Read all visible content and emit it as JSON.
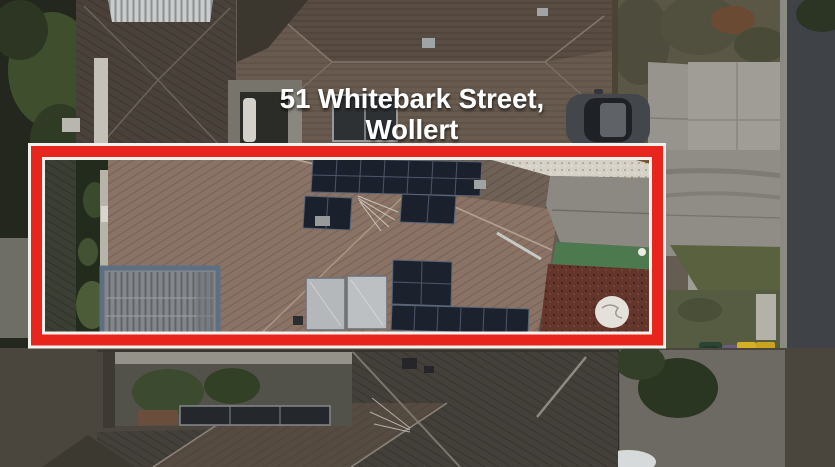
{
  "annotation": {
    "address_line1": "51 Whitebark Street,",
    "address_line2": "Wollert",
    "text_color": "#ffffff",
    "highlight_box": {
      "color": "#e8251d",
      "outline_color": "#f2f0ec"
    }
  },
  "scene": {
    "type": "aerial-drone-photo",
    "subject": "house rooftop with solar panels outlined in red",
    "colors": {
      "roof_warm_brown": "#8a7365",
      "roof_dark_brown": "#685a4e",
      "neighbor_roof_dark": "#434039",
      "solar_panel_dark": "#1c222d",
      "hot_water_panel_silver": "#b4b8ba",
      "pergola_grey": "#83868a",
      "gravel_white": "#d5d1c6",
      "mulch_red": "#63352b",
      "turf_green": "#4c7a4e",
      "road_grey": "#3f4347",
      "footpath_grey": "#a09e96",
      "grass_olive": "#565342",
      "bin_green": "#2c4434",
      "bin_purple": "#6d5a80",
      "bin_yellow": "#d4af24"
    }
  }
}
